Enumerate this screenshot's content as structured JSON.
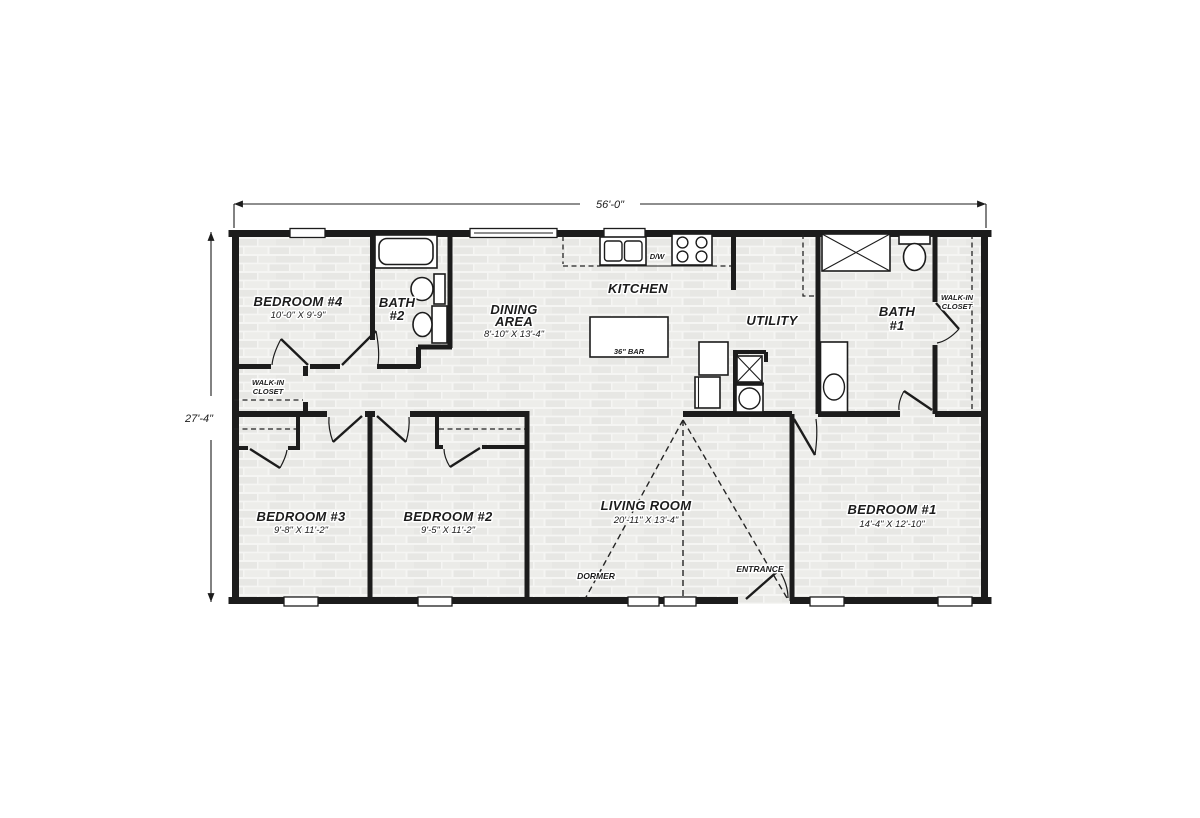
{
  "plan": {
    "title": "floor-plan",
    "dimensions": {
      "width": "56'-0\"",
      "depth": "27'-4\""
    },
    "rooms": [
      {
        "id": "bedroom4",
        "name": "BEDROOM #4",
        "dims": "10'-0\" X 9'-9\""
      },
      {
        "id": "bath2",
        "name": "BATH",
        "name2": "#2"
      },
      {
        "id": "wic-left",
        "name": "WALK-IN",
        "name2": "CLOSET"
      },
      {
        "id": "dining",
        "name": "DINING",
        "name2": "AREA",
        "dims": "8'-10\" X 13'-4\""
      },
      {
        "id": "kitchen",
        "name": "KITCHEN"
      },
      {
        "id": "utility",
        "name": "UTILITY"
      },
      {
        "id": "bath1",
        "name": "BATH",
        "name2": "#1"
      },
      {
        "id": "wic-right",
        "name": "WALK-IN",
        "name2": "CLOSET"
      },
      {
        "id": "bedroom3",
        "name": "BEDROOM #3",
        "dims": "9'-8\" X 11'-2\""
      },
      {
        "id": "bedroom2",
        "name": "BEDROOM #2",
        "dims": "9'-5\" X 11'-2\""
      },
      {
        "id": "living",
        "name": "LIVING ROOM",
        "dims": "20'-11\" X 13'-4\""
      },
      {
        "id": "bedroom1",
        "name": "BEDROOM #1",
        "dims": "14'-4\" X 12'-10\""
      }
    ],
    "labels": {
      "dormer": "DORMER",
      "entrance": "ENTRANCE",
      "bar": "36\" BAR",
      "dishwasher": "D/W"
    },
    "fixtures": [
      "bathtub",
      "pedestal-sink",
      "toilet",
      "shower",
      "vanity-sink",
      "kitchen-sink",
      "range",
      "refrigerator",
      "water-heater",
      "washer",
      "bar-island"
    ],
    "colors": {
      "wall": "#1c1c1c",
      "floor_brick": "#e7e7e4",
      "background": "#ffffff"
    }
  }
}
